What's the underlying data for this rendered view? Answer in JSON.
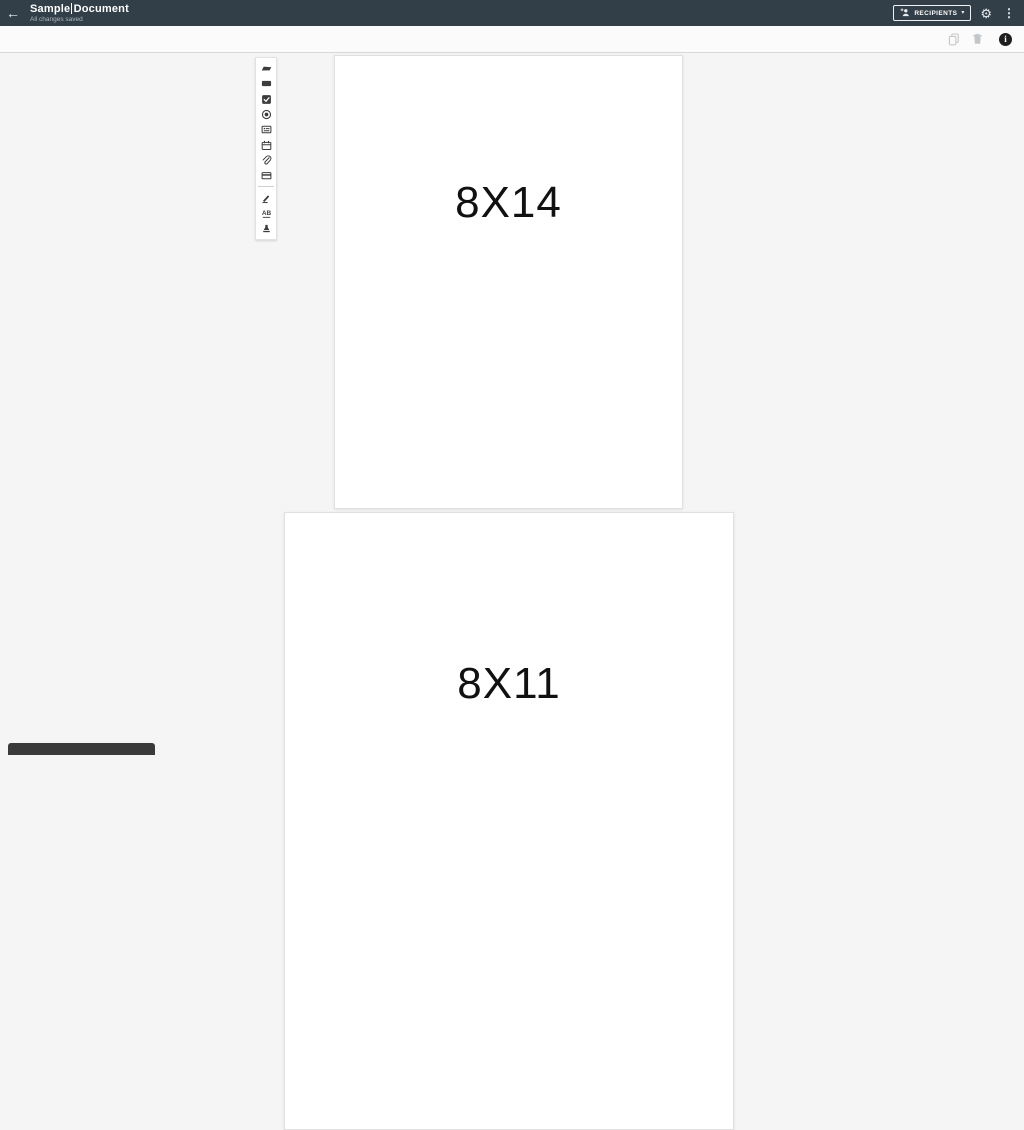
{
  "app_bar": {
    "back_glyph": "←",
    "title": "Sample Document",
    "status": "All changes saved",
    "recipients": {
      "label": "RECIPIENTS",
      "caret_glyph": "▾"
    },
    "gear_glyph": "⚙",
    "kebab_glyph": "⋮"
  },
  "doc_toolbar": {
    "info_glyph": "i",
    "icons": [
      "copy-icon",
      "trash-icon",
      "info-icon"
    ]
  },
  "palette": {
    "tools": [
      {
        "name": "text-tag"
      },
      {
        "name": "textbox"
      },
      {
        "name": "checkbox"
      },
      {
        "name": "radio"
      },
      {
        "name": "dropdown"
      },
      {
        "name": "date"
      },
      {
        "name": "attachment"
      },
      {
        "name": "card"
      },
      {
        "name": "signature"
      },
      {
        "name": "initials"
      },
      {
        "name": "stamp"
      }
    ],
    "initials_glyph": "AB"
  },
  "document": {
    "pages": [
      {
        "label": "8X14"
      },
      {
        "label": "8X11"
      }
    ]
  },
  "colors": {
    "app_bar_bg": "#323e48",
    "canvas_bg": "#f5f5f6",
    "page_bg": "#ffffff",
    "muted_icon": "#c4c7ca",
    "dark_icon": "#1f1f1f"
  }
}
